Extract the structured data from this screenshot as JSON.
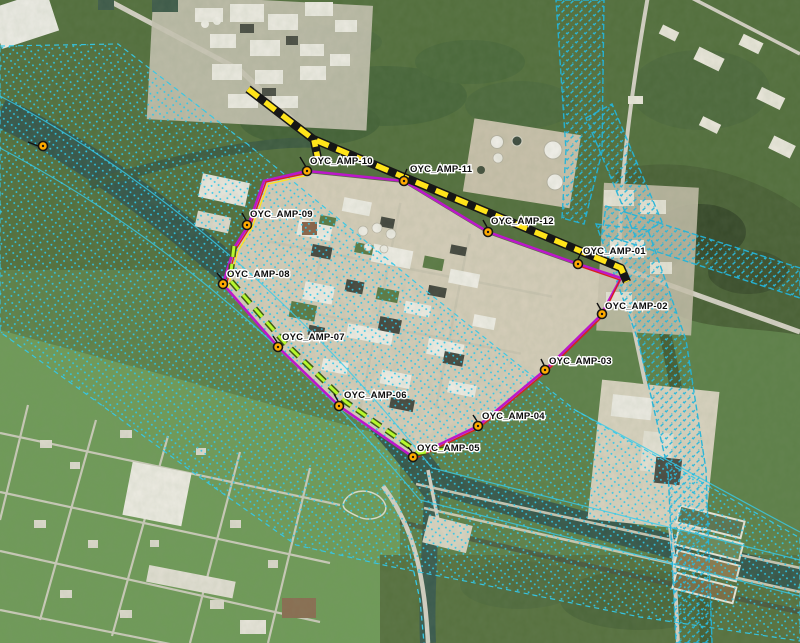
{
  "map": {
    "title": "Aerial imagery map with OYC AMP monitoring locations",
    "monitoring_points": [
      {
        "id": "oyc-amp-01",
        "label": "OYC_AMP-01"
      },
      {
        "id": "oyc-amp-02",
        "label": "OYC_AMP-02"
      },
      {
        "id": "oyc-amp-03",
        "label": "OYC_AMP-03"
      },
      {
        "id": "oyc-amp-04",
        "label": "OYC_AMP-04"
      },
      {
        "id": "oyc-amp-05",
        "label": "OYC_AMP-05"
      },
      {
        "id": "oyc-amp-06",
        "label": "OYC_AMP-06"
      },
      {
        "id": "oyc-amp-07",
        "label": "OYC_AMP-07"
      },
      {
        "id": "oyc-amp-08",
        "label": "OYC_AMP-08"
      },
      {
        "id": "oyc-amp-09",
        "label": "OYC_AMP-09"
      },
      {
        "id": "oyc-amp-10",
        "label": "OYC_AMP-10"
      },
      {
        "id": "oyc-amp-11",
        "label": "OYC_AMP-11"
      },
      {
        "id": "oyc-amp-12",
        "label": "OYC_AMP-12"
      }
    ],
    "unlabeled_markers": 1,
    "colors": {
      "boundary_magenta": "#bc17ca",
      "survey_red": "#d81f1f",
      "barrier_yellow": "#ffe41a",
      "segment_chartreuse": "#b6f72e",
      "hatch_cyan": "#2fc6e8",
      "marker_orange": "#ffaa00"
    }
  }
}
